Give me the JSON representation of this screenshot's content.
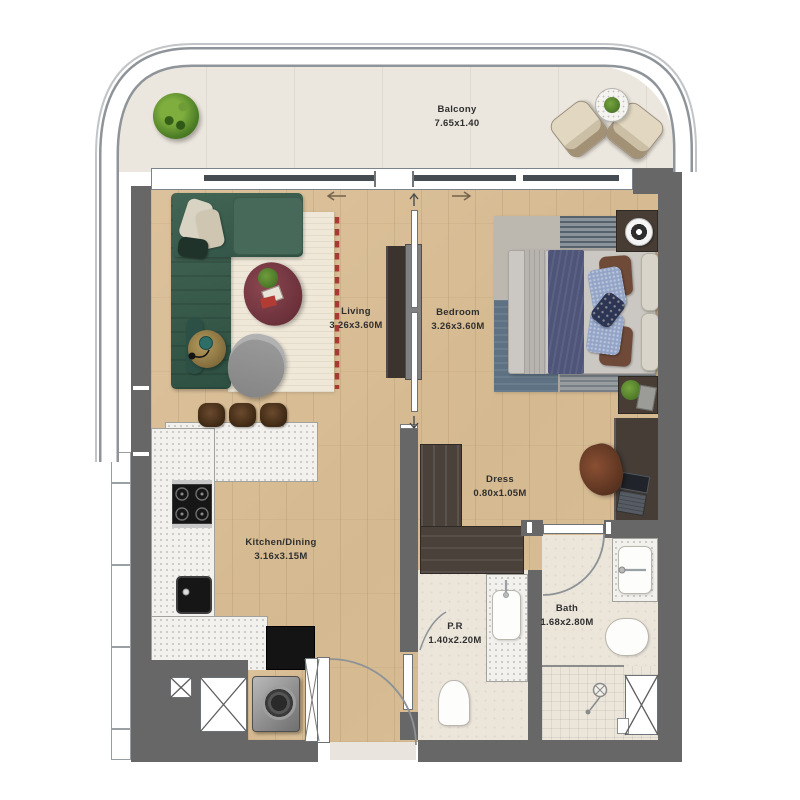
{
  "rooms": [
    {
      "id": "balcony",
      "label": "Balcony",
      "dims": "7.65x1.40"
    },
    {
      "id": "living",
      "label": "Living",
      "dims": "3.26x3.60M"
    },
    {
      "id": "bedroom",
      "label": "Bedroom",
      "dims": "3.26x3.60M"
    },
    {
      "id": "kitchen_dining",
      "label": "Kitchen/Dining",
      "dims": "3.16x3.15M"
    },
    {
      "id": "dress",
      "label": "Dress",
      "dims": "0.80x1.05M"
    },
    {
      "id": "powder_room",
      "label": "P.R",
      "dims": "1.40x2.20M"
    },
    {
      "id": "bath",
      "label": "Bath",
      "dims": "1.68x2.80M"
    }
  ],
  "palette": {
    "wall_gray": "#676767",
    "wood_floor": "#d8bd97",
    "balcony_floor": "#ece7de",
    "bathroom_tile": "#ebe5da",
    "counter_terrazzo": "#f2f1ee",
    "sofa_green": "#3e6151",
    "coffee_table_maroon": "#7c3d44",
    "bed_throw_navy": "#4e5578",
    "rug_cream": "#efe8d9",
    "rug_fringe_red": "#a83a36",
    "label_text": "#2f2f2f"
  }
}
